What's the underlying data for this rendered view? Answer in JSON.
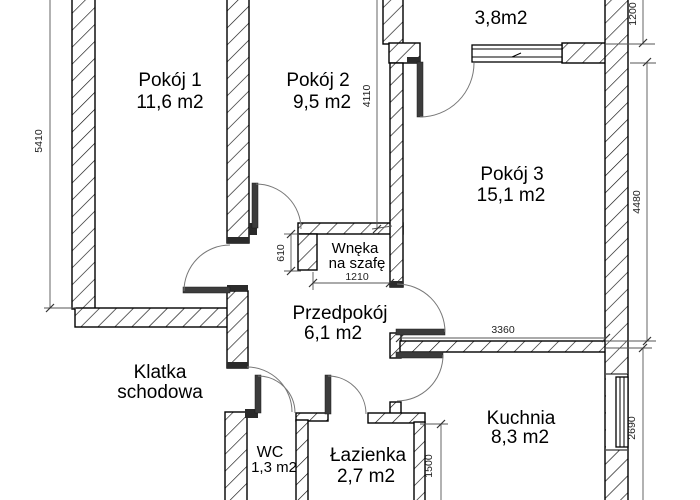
{
  "plan": {
    "type": "apartment-floor-plan",
    "rooms": {
      "pokoj1": {
        "name": "Pokój 1",
        "area": "11,6 m2"
      },
      "pokoj2": {
        "name": "Pokój 2",
        "area": "9,5 m2"
      },
      "pokoj3": {
        "name": "Pokój 3",
        "area": "15,1 m2"
      },
      "balkon": {
        "name": "Balkon",
        "area": "3,8m2"
      },
      "wneka": {
        "line1": "Wnęka",
        "line2": "na szafę"
      },
      "przedpokoj": {
        "name": "Przedpokój",
        "area": "6,1 m2"
      },
      "klatka": {
        "line1": "Klatka",
        "line2": "schodowa"
      },
      "wc": {
        "name": "WC",
        "area": "1,3 m2"
      },
      "lazienka": {
        "name": "Łazienka",
        "area": "2,7 m2"
      },
      "kuchnia": {
        "name": "Kuchnia",
        "area": "8,3 m2"
      }
    },
    "dimensions_mm": {
      "side_left": "5410",
      "pokoj2_side": "4110",
      "balkon_side": "1200",
      "pokoj3_side": "4480",
      "kuchnia_side": "2690",
      "kuchnia_top": "3360",
      "lazienka_side": "1500",
      "wneka_depth": "610",
      "wneka_width": "1210"
    },
    "colors": {
      "line": "#000000",
      "background": "#ffffff",
      "dimension": "#555555"
    }
  }
}
